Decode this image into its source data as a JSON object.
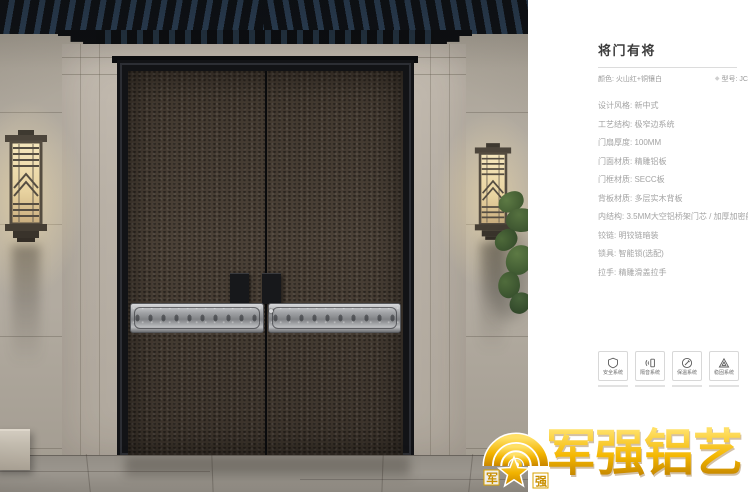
{
  "panel": {
    "title": "将门有将",
    "subtitle": {
      "color": "颜色: 火山红+铜镶白",
      "model_icon": "◆",
      "model": "型号: JC"
    },
    "specs": [
      "设计风格: 新中式",
      "工艺结构: 极窄边系统",
      "门扇厚度: 100MM",
      "门面材质: 精雕铝板",
      "门框材质: SECC板",
      "背板材质: 多层实木背板",
      "内结构: 3.5MM大空铝桥架门芯 / 加厚加密航空铝芯",
      "铰链: 明铰链暗装",
      "锁具: 智能锁(选配)",
      "拉手: 精雕滑盖拉手"
    ],
    "features": [
      {
        "icon": "shield-icon",
        "label": "安全系统"
      },
      {
        "icon": "sound-insulation-icon",
        "label": "隔音系统"
      },
      {
        "icon": "thermal-seal-icon",
        "label": "保温系统"
      },
      {
        "icon": "stability-icon",
        "label": "稳固系统"
      }
    ]
  },
  "logo": {
    "brand": "军强铝艺",
    "emblem_left": "军",
    "emblem_right": "强"
  },
  "colors": {
    "gold": "#f2b705",
    "door_leaf": "#463c32",
    "door_frame": "#17181a",
    "silver_band": "#aeb0b3",
    "wall": "#b1aa9f",
    "floor": "#938e86",
    "eave_rafter": "#2a3d52",
    "spec_text": "#a3a3a3",
    "title_text": "#3c3c3c"
  }
}
